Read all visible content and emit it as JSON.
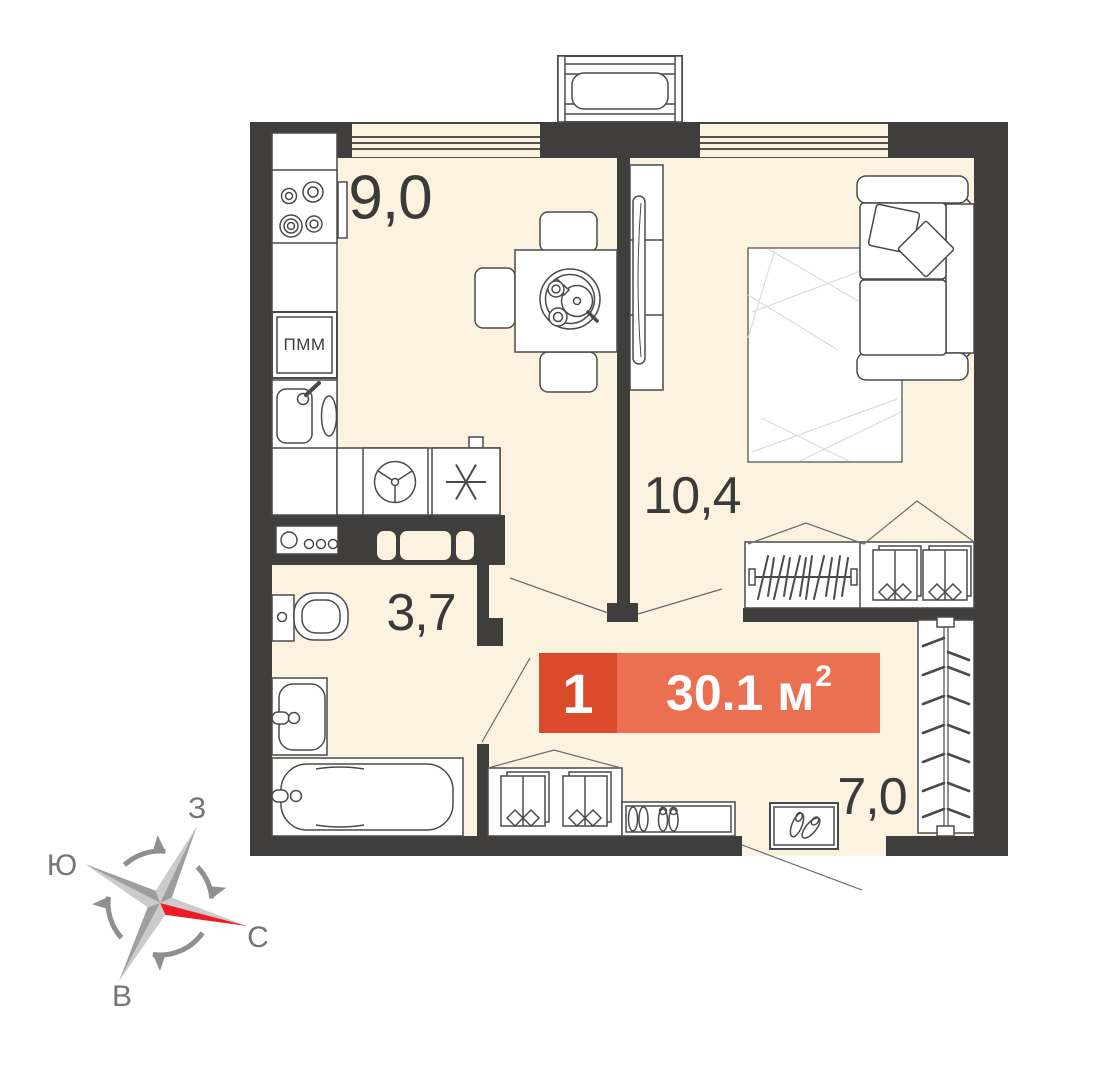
{
  "rooms": {
    "kitchen": {
      "label": "9,0"
    },
    "living": {
      "label": "10,4"
    },
    "bathroom": {
      "label": "3,7"
    },
    "hallway": {
      "label": "7,0"
    }
  },
  "badge": {
    "rooms_count": "1",
    "area_value": "30.1 м",
    "area_exponent": "2",
    "bg_left": "#d94b2b",
    "bg_right": "#eb7052"
  },
  "appliances": {
    "dishwasher_label": "ПММ"
  },
  "compass": {
    "west": "З",
    "south": "Ю",
    "north": "С",
    "east": "В",
    "north_arrow_color": "#ed1c24"
  },
  "palette": {
    "wall": "#403e3c",
    "floor": "#fbf2e0",
    "outline": "#4a4a4a",
    "label_text": "#3b3a39"
  }
}
